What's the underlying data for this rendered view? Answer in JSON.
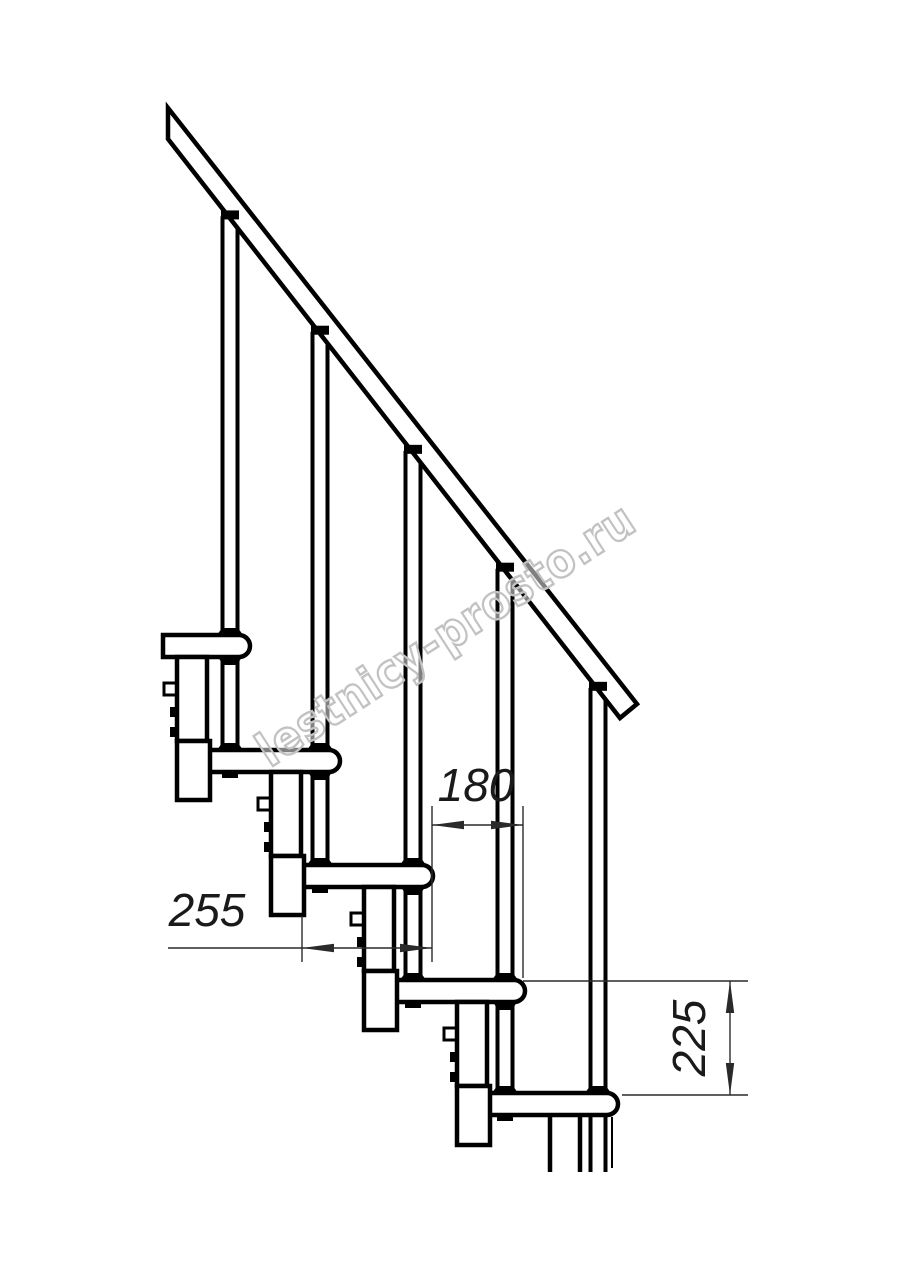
{
  "page": {
    "background": "#ffffff",
    "type": "technical drawing",
    "subject": "modular staircase side elevation"
  },
  "watermark": {
    "text": "lestnicy-prosto.ru",
    "color": "#c2c2c2"
  },
  "dimensions": {
    "step_run": {
      "value": "180",
      "orientation": "horizontal"
    },
    "tread_depth": {
      "value": "255",
      "orientation": "horizontal"
    },
    "step_rise": {
      "value": "225",
      "orientation": "vertical"
    }
  },
  "drawing": {
    "line_color": "#000000",
    "dim_color": "#2a2a2a",
    "steps_count": 5,
    "cut_y": 1172,
    "rail": {
      "top": [
        168,
        108,
        637,
        704
      ],
      "low": [
        168,
        139,
        620,
        718
      ]
    },
    "tread": {
      "height": 22,
      "nose_radius": 11,
      "rise": 115
    },
    "steps": [
      {
        "x": 163,
        "y": 635,
        "nose": 250,
        "baluster_x": 230,
        "nut_x": 196,
        "next_x": 208,
        "next_y": 750
      },
      {
        "x": 208,
        "y": 750,
        "nose": 340,
        "baluster_x": 320,
        "nut_x": 230,
        "next_x": 302,
        "next_y": 865
      },
      {
        "x": 302,
        "y": 865,
        "nose": 433,
        "baluster_x": 413,
        "nut_x": 320,
        "next_x": 395,
        "next_y": 980
      },
      {
        "x": 395,
        "y": 980,
        "nose": 525,
        "baluster_x": 505,
        "nut_x": 413,
        "next_x": 488,
        "next_y": 1093
      },
      {
        "x": 488,
        "y": 1093,
        "nose": 618,
        "baluster_x": 598,
        "nut_x": 505,
        "next_x": 581,
        "next_y": null
      }
    ]
  }
}
